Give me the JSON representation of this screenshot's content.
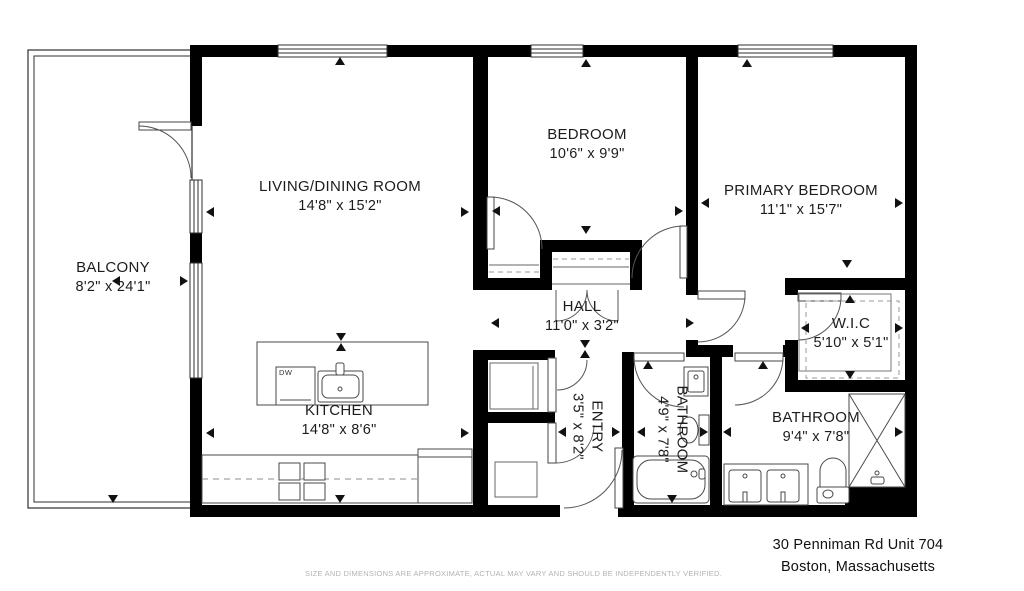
{
  "colors": {
    "wall": "#000000",
    "thin_line": "#4a4a4a",
    "dashed_line": "#8c8c8c",
    "label_text": "#1c1c1c",
    "muted_text": "#b3b3b3"
  },
  "rooms": {
    "balcony": {
      "name": "BALCONY",
      "dims": "8'2\" x 24'1\""
    },
    "living": {
      "name": "LIVING/DINING ROOM",
      "dims": "14'8\" x 15'2\""
    },
    "bedroom": {
      "name": "BEDROOM",
      "dims": "10'6\" x 9'9\""
    },
    "primary": {
      "name": "PRIMARY BEDROOM",
      "dims": "11'1\" x 15'7\""
    },
    "hall": {
      "name": "HALL",
      "dims": "11'0\" x 3'2\""
    },
    "wic": {
      "name": "W.I.C",
      "dims": "5'10\" x 5'1\""
    },
    "kitchen": {
      "name": "KITCHEN",
      "dims": "14'8\" x 8'6\""
    },
    "entry": {
      "name": "ENTRY",
      "dims": "3'5\" x 8'2\""
    },
    "bathroom1": {
      "name": "BATHROOM",
      "dims": "4'9\" x 7'8\""
    },
    "bathroom2": {
      "name": "BATHROOM",
      "dims": "9'4\" x 7'8\""
    }
  },
  "appliances": {
    "dishwasher": "DW"
  },
  "footer": {
    "address_line1": "30 Penniman Rd Unit 704",
    "address_line2": "Boston, Massachusetts",
    "disclaimer": "SIZE AND DIMENSIONS ARE APPROXIMATE, ACTUAL MAY VARY AND SHOULD BE INDEPENDENTLY VERIFIED."
  }
}
